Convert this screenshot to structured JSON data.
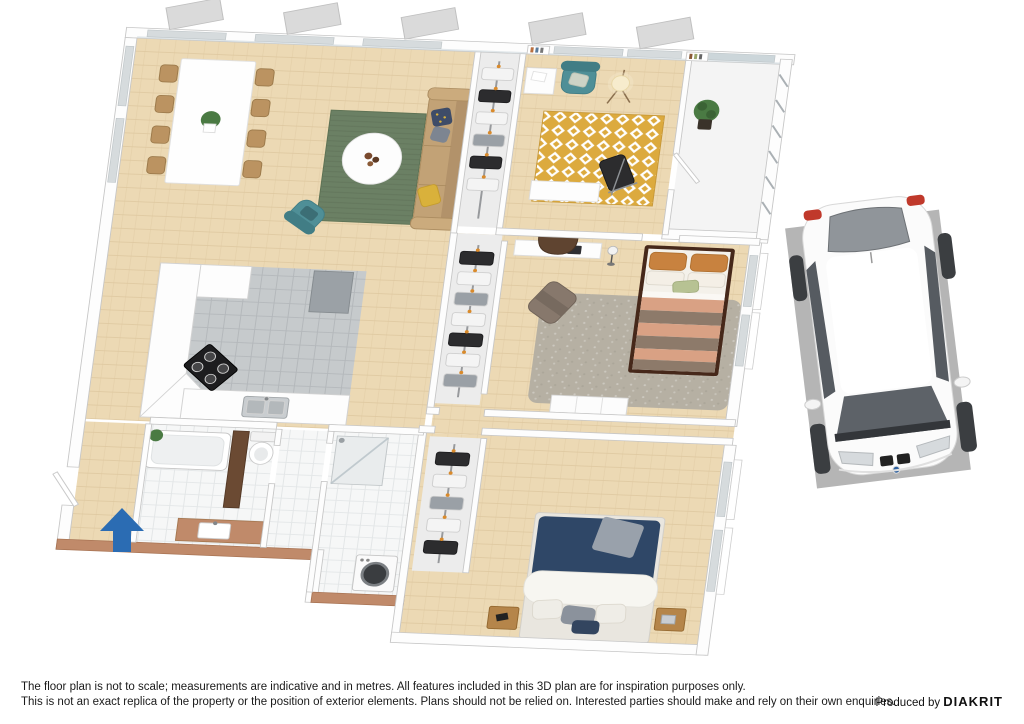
{
  "footer": {
    "disclaimer_line1": "The floor plan is not to scale; measurements are indicative and in metres. All features included in this 3D plan are for inspiration purposes only.",
    "disclaimer_line2": "This is not an exact replica of the property or the position of exterior elements. Plans should not be relied on. Interested parties should make and rely on their own enquiries.",
    "credit_prefix": "Produced by ",
    "credit_brand": "DIAKRIT"
  },
  "colors": {
    "floor_wood": "#ecd9b4",
    "floor_wood_line": "#dcc69c",
    "kitchen_floor": "#c6cacc",
    "tile_white": "#f6f7f7",
    "wall_fill": "#fdfdfd",
    "wall_edge": "#c6c6c6",
    "rug_green": "#6b8064",
    "rug_yellow": "#dcaa3e",
    "rug_gray": "#b6b0a3",
    "sofa_tan": "#c2a276",
    "armchair_teal": "#4f8f97",
    "bed_stripe_peach": "#d9a184",
    "bed_stripe_taupe": "#8d7a6a",
    "pillow_orange": "#c8823f",
    "bed_navy": "#2f4767",
    "terracotta": "#c08a6a",
    "wood_furniture": "#b5854a",
    "parking_pad": "#b5b5b5",
    "car_body": "#fbfbfb",
    "glass_dark": "#5d6268",
    "entrance_arrow": "#2b6cb3",
    "plant_green": "#4a7a43"
  }
}
